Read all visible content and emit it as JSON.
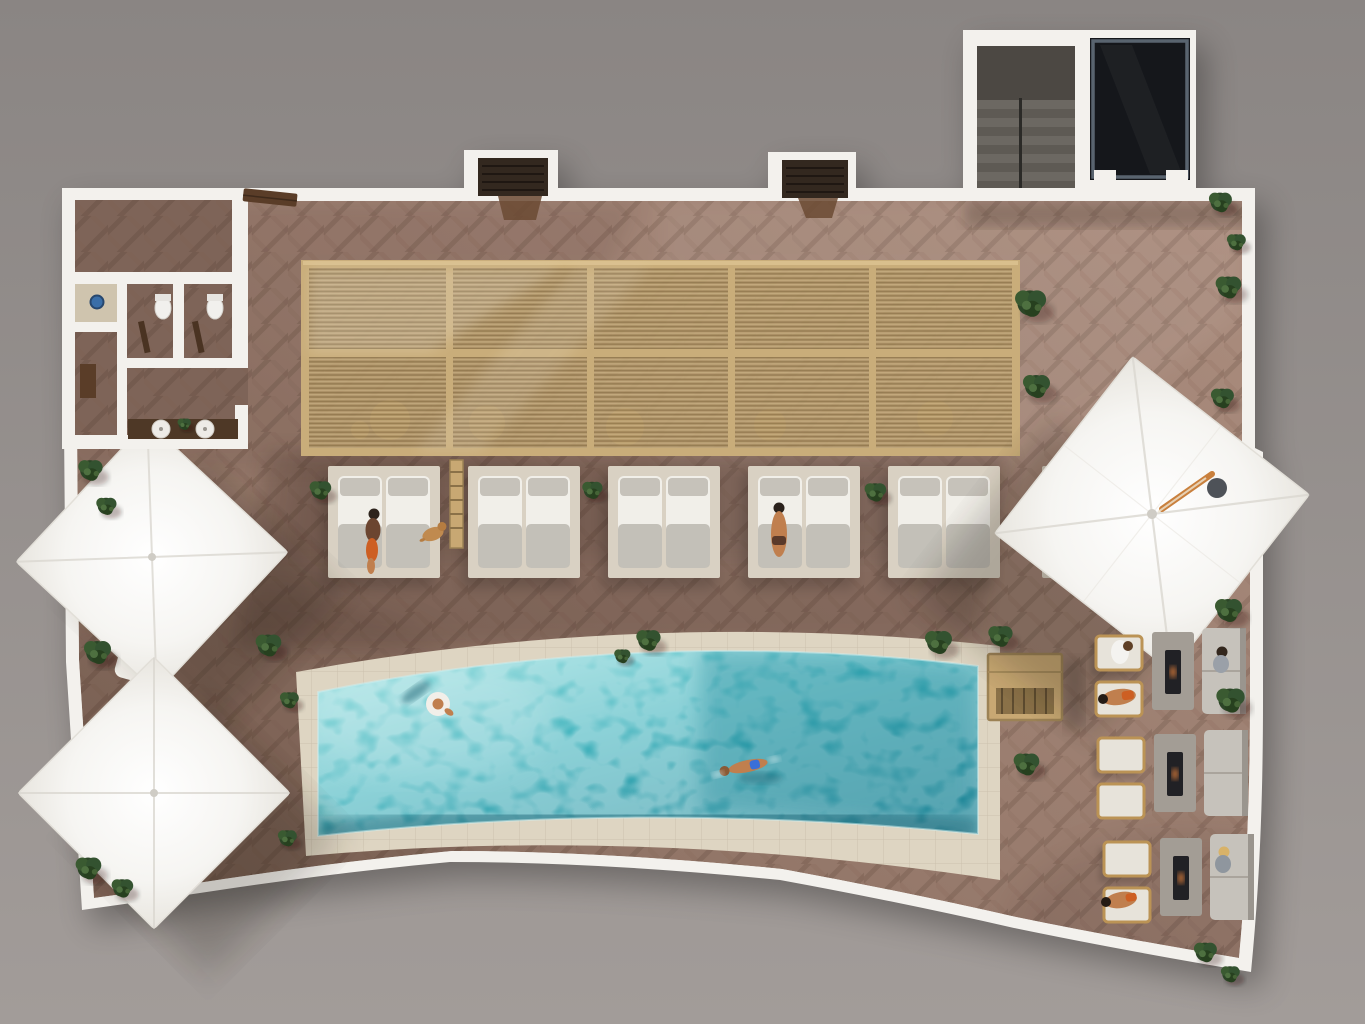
{
  "scene": {
    "kind": "architectural-render-top-view",
    "setting": "rooftop pool deck with pergola cabanas, sun umbrellas and fire-pit lounges",
    "inventory": {
      "pergola_bays": 5,
      "cabana_daybeds": 6,
      "sun_umbrellas": 3,
      "sun_loungers": 3,
      "fire_pit_lounge_groups": 3,
      "armchairs": 6,
      "sofas": 3,
      "pools": 1,
      "pool_floats": 1,
      "swimmers": 1,
      "people": 11,
      "dogs": 1,
      "wc_stalls": 2,
      "showers": 1,
      "vanity_sinks": 2,
      "stairwells": 1,
      "skylight_rooms": 1,
      "planters": 26
    }
  },
  "colors": {
    "bg_top": "#8a8583",
    "bg_bottom": "#a29c99",
    "wall": "#f3f1ed",
    "deck_light": "#ab8d7e",
    "deck_mid": "#9a7d6f",
    "deck_dark": "#826759",
    "stone": "#ded5c2",
    "pool_light": "#8fdede",
    "pool_mid": "#3fb3bd",
    "pool_deep": "#1d8496",
    "pool_shadow": "#135f70",
    "pergola_frame": "#c9ad7a",
    "pergola_slats": "#b59a6c",
    "umbrella": "#f6f5f2",
    "platform": "#d9d1c3",
    "mattress": "#f1efe9",
    "pillow": "#c6c2ba",
    "plant": "#2c4527",
    "plant_light": "#3a5a31",
    "fire_table": "#a39d95",
    "fire_glass": "#212125",
    "sofa": "#c6c2bb",
    "chair_wood": "#bb9355",
    "cushion": "#e7e3da",
    "stair": "#56524d",
    "stair_tread": "#6c6862",
    "darkroom": "#15171b",
    "darkroom_frame": "#59646f",
    "skin": "#c07f4e",
    "towel": "#cd5f23",
    "swim_blue": "#3a6fd8",
    "woodbox": "#c8a873",
    "vanity": "#4e3826",
    "shower_tile": "#cfc4ae",
    "shower_blue": "#3a6ea8",
    "bench": "#5a3d28",
    "bump": "#33281f"
  }
}
